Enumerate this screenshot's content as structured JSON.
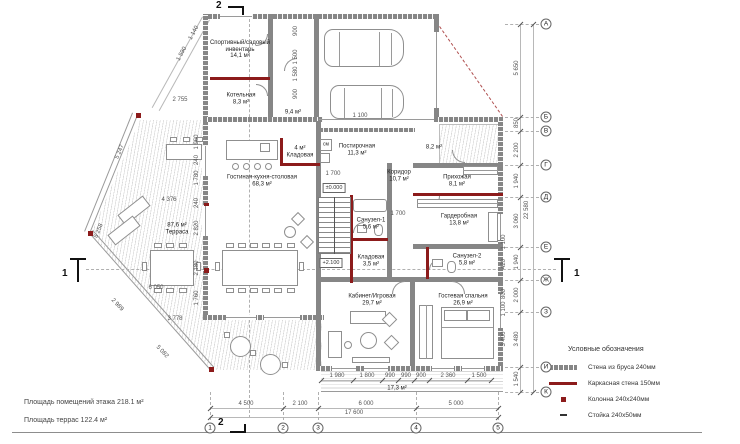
{
  "colors": {
    "timber_wall": "#868686",
    "frame_wall": "#8C1B1B",
    "dims": "#555555"
  },
  "notes": {
    "line1": "Площадь помещений этажа 218.1 м²",
    "line2": "Площадь террас 122.4 м²"
  },
  "legend": {
    "title": "Условные обозначения",
    "items": [
      {
        "swatch": "timber-wall",
        "label": "Стена из бруса 240мм"
      },
      {
        "swatch": "frame-wall",
        "label": "Каркасная стена 150мм"
      },
      {
        "swatch": "column",
        "label": "Колонна 240x240мм"
      },
      {
        "swatch": "post",
        "label": "Стойка 240x50мм"
      }
    ]
  },
  "rooms": [
    {
      "lines": [
        "Спортивный/садовый",
        "инвентарь",
        "14,1 м²"
      ],
      "x": 240,
      "y": 50
    },
    {
      "lines": [
        "Котельная",
        "8,3 м²"
      ],
      "x": 241,
      "y": 99
    },
    {
      "lines": [
        "9,4 м²"
      ],
      "x": 293,
      "y": 113
    },
    {
      "lines": [
        "4 м²",
        "Кладовая"
      ],
      "x": 300,
      "y": 152
    },
    {
      "lines": [
        "Постирочная",
        "11,3 м²"
      ],
      "x": 357,
      "y": 150
    },
    {
      "lines": [
        "8,2 м²"
      ],
      "x": 434,
      "y": 148
    },
    {
      "lines": [
        "Гостиная-кухня-столовая",
        "68,3 м²"
      ],
      "x": 262,
      "y": 181
    },
    {
      "lines": [
        "Коридор",
        "10,7 м²"
      ],
      "x": 399,
      "y": 176
    },
    {
      "lines": [
        "Прихожая",
        "8,1 м²"
      ],
      "x": 457,
      "y": 181
    },
    {
      "lines": [
        "87,6 м²",
        "Терраса"
      ],
      "x": 177,
      "y": 229
    },
    {
      "lines": [
        "Санузел-1",
        "5,6 м²"
      ],
      "x": 371,
      "y": 224
    },
    {
      "lines": [
        "Гардеробная",
        "13,8 м²"
      ],
      "x": 459,
      "y": 220
    },
    {
      "lines": [
        "Кладовая",
        "3,5 м²"
      ],
      "x": 371,
      "y": 261
    },
    {
      "lines": [
        "Санузел-2",
        "5,8 м²"
      ],
      "x": 467,
      "y": 260
    },
    {
      "lines": [
        "Кабинет/Игровая",
        "29,7 м²"
      ],
      "x": 372,
      "y": 300
    },
    {
      "lines": [
        "Гостевая спальня",
        "26,9 м²"
      ],
      "x": 463,
      "y": 300
    },
    {
      "lines": [
        "17,3 м²"
      ],
      "x": 397,
      "y": 389
    }
  ],
  "labels": {
    "washer": "см"
  },
  "elevations": [
    {
      "text": "±0.000",
      "x": 334,
      "y": 188
    },
    {
      "text": "+2.100",
      "x": 331,
      "y": 263
    }
  ],
  "sections": {
    "one": "1",
    "two": "2"
  },
  "axes_letters": [
    {
      "label": "А",
      "y": 24
    },
    {
      "label": "Б",
      "y": 117
    },
    {
      "label": "В",
      "y": 131
    },
    {
      "label": "Г",
      "y": 165
    },
    {
      "label": "Д",
      "y": 197
    },
    {
      "label": "Е",
      "y": 247
    },
    {
      "label": "Ж",
      "y": 280
    },
    {
      "label": "З",
      "y": 312
    },
    {
      "label": "И",
      "y": 367
    },
    {
      "label": "К",
      "y": 392
    }
  ],
  "axes_numbers": [
    {
      "label": "1",
      "x": 210
    },
    {
      "label": "2",
      "x": 283
    },
    {
      "label": "3",
      "x": 318
    },
    {
      "label": "4",
      "x": 416
    },
    {
      "label": "5",
      "x": 498
    }
  ],
  "dims_right": [
    {
      "text": "5 650",
      "y": 68
    },
    {
      "text": "850",
      "y": 123
    },
    {
      "text": "2 200",
      "y": 150
    },
    {
      "text": "1 940",
      "y": 181
    },
    {
      "text": "3 060",
      "y": 221
    },
    {
      "text": "1 940",
      "y": 262
    },
    {
      "text": "2 000",
      "y": 295
    },
    {
      "text": "3 480",
      "y": 339
    },
    {
      "text": "1 540",
      "y": 379
    }
  ],
  "dims_right_inner": [
    {
      "text": "1 100",
      "y": 242
    },
    {
      "text": "420",
      "y": 264
    },
    {
      "text": "800",
      "y": 294
    },
    {
      "text": "1 100",
      "y": 309
    },
    {
      "text": "3 400",
      "y": 339
    }
  ],
  "dims_right_total": "22 580",
  "dims_bottom": [
    {
      "text": "4 500",
      "x": 246
    },
    {
      "text": "2 100",
      "x": 300
    },
    {
      "text": "6 000",
      "x": 366
    },
    {
      "text": "5 000",
      "x": 456
    }
  ],
  "dims_bottom_total": "17 600",
  "dims_bottom_inner": [
    {
      "text": "1 980",
      "x": 337
    },
    {
      "text": "1 800",
      "x": 367
    },
    {
      "text": "990",
      "x": 390
    },
    {
      "text": "990",
      "x": 406
    },
    {
      "text": "900",
      "x": 421
    },
    {
      "text": "2 360",
      "x": 448
    },
    {
      "text": "1 500",
      "x": 479
    }
  ],
  "dims_left_col": [
    {
      "text": "1 960",
      "y": 142
    },
    {
      "text": "240",
      "y": 160
    },
    {
      "text": "1 780",
      "y": 178
    },
    {
      "text": "240",
      "y": 203
    },
    {
      "text": "2 820",
      "y": 228
    },
    {
      "text": "2 180",
      "y": 268
    },
    {
      "text": "1 760",
      "y": 298
    }
  ],
  "dims_misc": [
    {
      "text": "5 247",
      "x": 120,
      "y": 152,
      "rot": -67
    },
    {
      "text": "5 258",
      "x": 99,
      "y": 231,
      "rot": -67
    },
    {
      "text": "2 989",
      "x": 117,
      "y": 305,
      "rot": 46
    },
    {
      "text": "5 082",
      "x": 162,
      "y": 352,
      "rot": 46
    },
    {
      "text": "6 050",
      "x": 156,
      "y": 288,
      "rot": 0
    },
    {
      "text": "3 778",
      "x": 175,
      "y": 319,
      "rot": 0
    },
    {
      "text": "4 376",
      "x": 169,
      "y": 200,
      "rot": 0
    },
    {
      "text": "2 755",
      "x": 180,
      "y": 100,
      "rot": 0
    },
    {
      "text": "1 590",
      "x": 182,
      "y": 54,
      "rot": -62
    },
    {
      "text": "1 140",
      "x": 194,
      "y": 33,
      "rot": -62
    },
    {
      "text": "1 700",
      "x": 333,
      "y": 174,
      "rot": 0
    },
    {
      "text": "1 700",
      "x": 398,
      "y": 214,
      "rot": 0
    },
    {
      "text": "1 100",
      "x": 360,
      "y": 116,
      "rot": 0
    },
    {
      "text": "900",
      "x": 296,
      "y": 31,
      "rot": -90
    },
    {
      "text": "1 500",
      "x": 296,
      "y": 57,
      "rot": -90
    },
    {
      "text": "1 580",
      "x": 296,
      "y": 74,
      "rot": -90
    },
    {
      "text": "900",
      "x": 296,
      "y": 94,
      "rot": -90
    }
  ]
}
